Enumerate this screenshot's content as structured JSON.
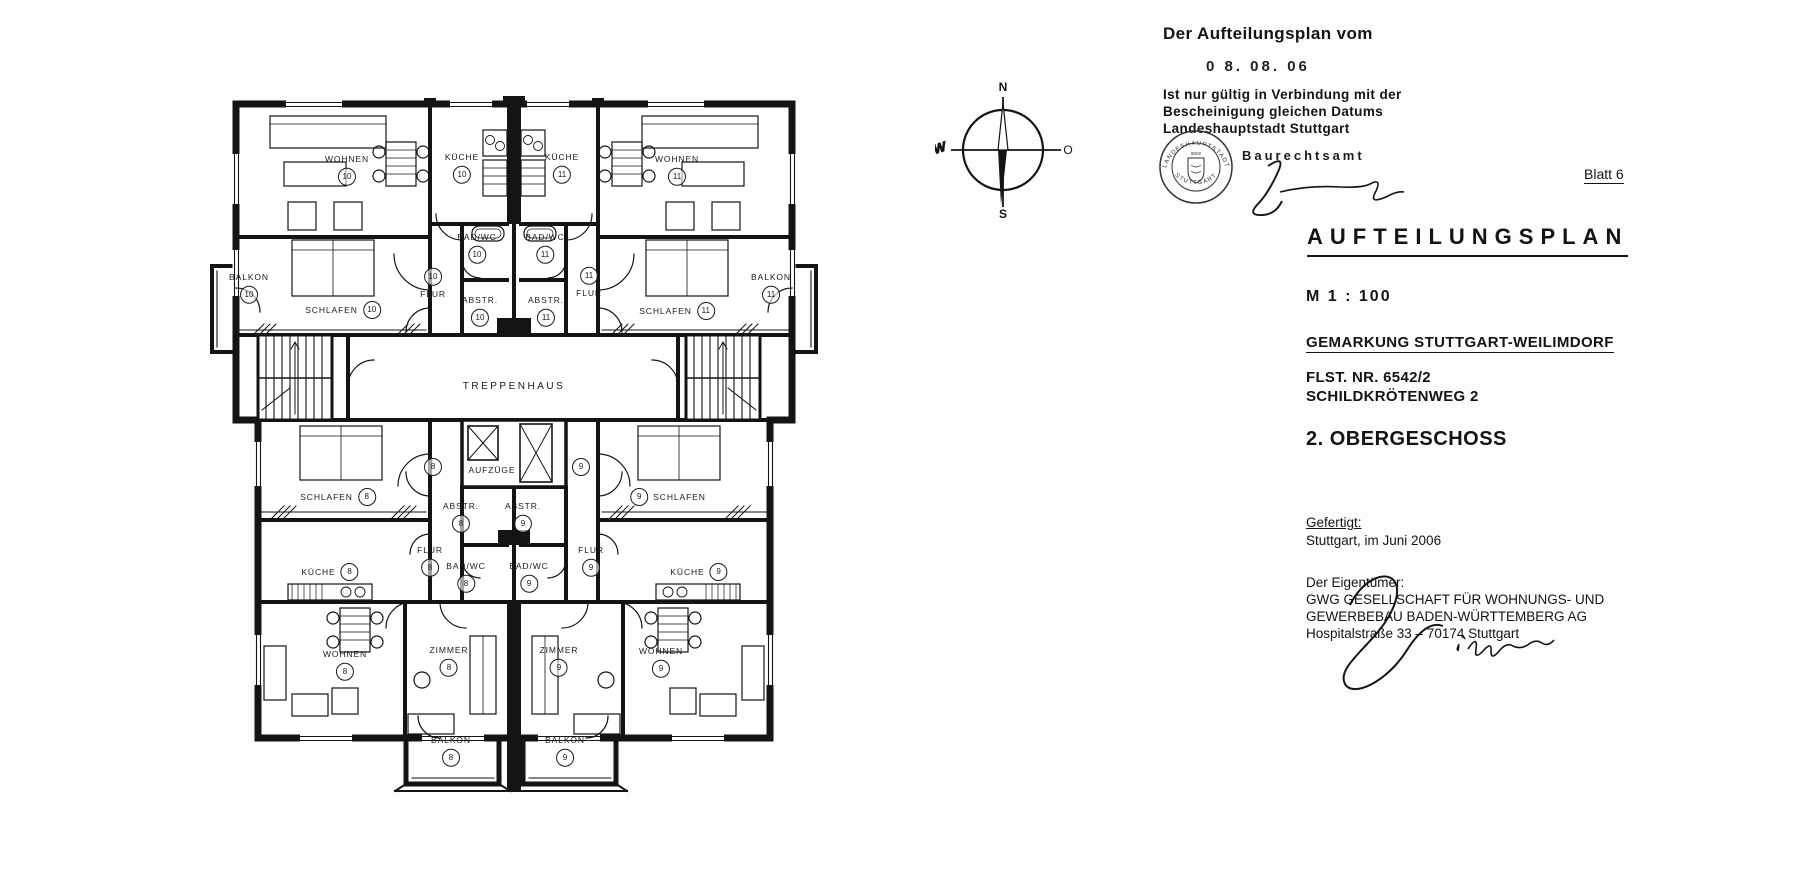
{
  "compass": {
    "north": "N",
    "east": "O",
    "south": "S",
    "west": "W"
  },
  "plan": {
    "core": {
      "stairwell": "TREPPENHAUS",
      "elevators": "AUFZÜGE"
    },
    "loose_units": [
      "8",
      "9"
    ],
    "rooms": [
      {
        "label": "WOHNEN",
        "unit": "10"
      },
      {
        "label": "KÜCHE",
        "unit": "10"
      },
      {
        "label": "KÜCHE",
        "unit": "11"
      },
      {
        "label": "WOHNEN",
        "unit": "11"
      },
      {
        "label": "BALKON",
        "unit": "10"
      },
      {
        "label": "SCHLAFEN",
        "unit": "10"
      },
      {
        "label": "FLUR",
        "unit": "10"
      },
      {
        "label": "BAD/WC",
        "unit": "10"
      },
      {
        "label": "ABSTR.",
        "unit": "10"
      },
      {
        "label": "BAD/WC",
        "unit": "11"
      },
      {
        "label": "ABSTR.",
        "unit": "11"
      },
      {
        "label": "FLUR",
        "unit": "11"
      },
      {
        "label": "SCHLAFEN",
        "unit": "11"
      },
      {
        "label": "BALKON",
        "unit": "11"
      },
      {
        "label": "SCHLAFEN",
        "unit": "8"
      },
      {
        "label": "SCHLAFEN",
        "unit": "9"
      },
      {
        "label": "FLUR",
        "unit": "8"
      },
      {
        "label": "FLUR",
        "unit": "9"
      },
      {
        "label": "KÜCHE",
        "unit": "8"
      },
      {
        "label": "KÜCHE",
        "unit": "9"
      },
      {
        "label": "ABSTR.",
        "unit": "8"
      },
      {
        "label": "ABSTR.",
        "unit": "9"
      },
      {
        "label": "BAD/WC",
        "unit": "8"
      },
      {
        "label": "BAD/WC",
        "unit": "9"
      },
      {
        "label": "WOHNEN",
        "unit": "8"
      },
      {
        "label": "ZIMMER",
        "unit": "8"
      },
      {
        "label": "ZIMMER",
        "unit": "9"
      },
      {
        "label": "WOHNEN",
        "unit": "9"
      },
      {
        "label": "BALKON",
        "unit": "8"
      },
      {
        "label": "BALKON",
        "unit": "9"
      }
    ]
  },
  "approval": {
    "heading": "Der Aufteilungsplan vom",
    "date": "0 8. 08. 06",
    "validity": "Ist nur gültig in Verbindung mit der\nBescheinigung gleichen Datums\nLandeshauptstadt Stuttgart",
    "office": "Baurechtsamt",
    "seal": {
      "top": "LANDESHAUPTSTADT",
      "bottom": "STUTTGART",
      "number": "6502"
    }
  },
  "titleblock": {
    "sheet": "Blatt 6",
    "title": "AUFTEILUNGSPLAN",
    "scale": "M 1 : 100",
    "district": "GEMARKUNG STUTTGART-WEILIMDORF",
    "parcel_lines": "FLST. NR. 6542/2\nSCHILDKRÖTENWEG 2",
    "floor": "2. OBERGESCHOSS",
    "prepared_label": "Gefertigt:",
    "prepared": "Stuttgart, im Juni 2006",
    "owner_label": "Der Eigentümer:",
    "owner_lines": "GWG GESELLSCHAFT FÜR WOHNUNGS- UND\nGEWERBEBAU BADEN-WÜRTTEMBERG AG\nHospitalstraße 33 – 70174 Stuttgart"
  }
}
